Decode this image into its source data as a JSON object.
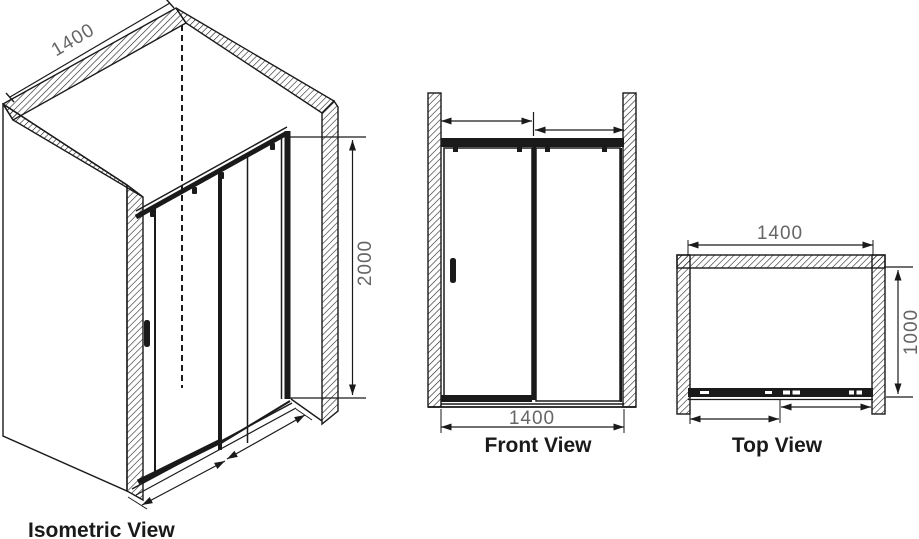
{
  "drawing": {
    "type": "technical-orthographic-drawing",
    "subject": "sliding-door-shower-enclosure",
    "background_color": "#ffffff",
    "line_color": "#1a1a1a",
    "dim_text_color": "#666666",
    "views": {
      "isometric": {
        "label": "Isometric View",
        "width_dim": "1400",
        "height_dim": "2000"
      },
      "front": {
        "label": "Front View",
        "width_dim": "1400"
      },
      "top": {
        "label": "Top View",
        "width_dim": "1400",
        "depth_dim": "1000"
      }
    }
  }
}
